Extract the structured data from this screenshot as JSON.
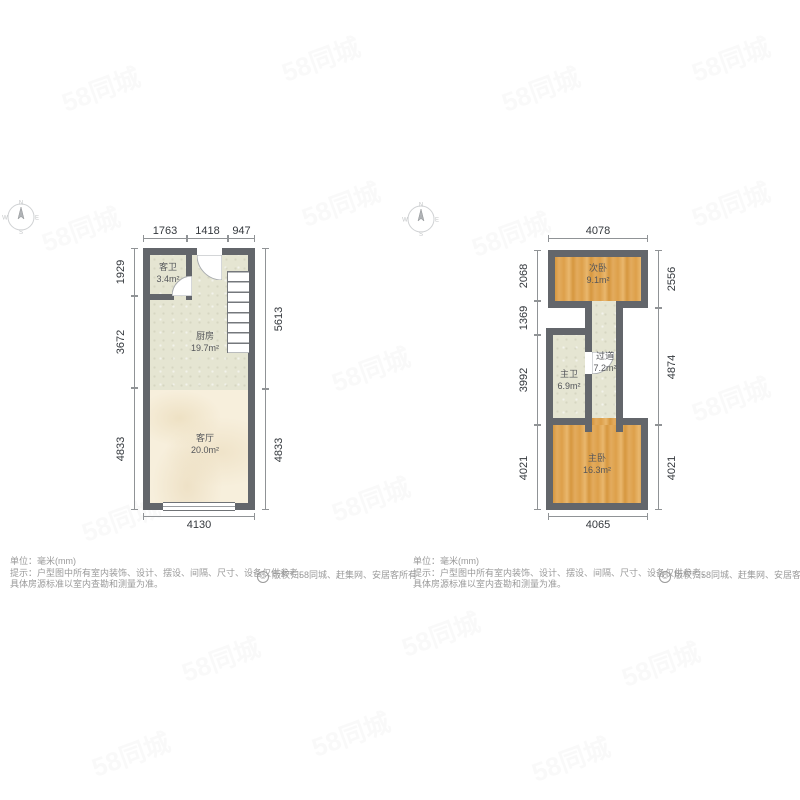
{
  "floor1": {
    "dims": {
      "top1": "1763",
      "top2": "1418",
      "top3": "947",
      "left1": "1929",
      "left2": "3672",
      "left3": "4833",
      "right1": "5613",
      "right2": "4833",
      "bottom": "4130"
    },
    "rooms": {
      "guest_bath": {
        "name": "客卫",
        "area": "3.4m²"
      },
      "kitchen": {
        "name": "厨房",
        "area": "19.7m²"
      },
      "living": {
        "name": "客厅",
        "area": "20.0m²"
      }
    }
  },
  "floor2": {
    "dims": {
      "top1": "4078",
      "left1": "2068",
      "left2": "1369",
      "left3": "3992",
      "left4": "4021",
      "right1": "2556",
      "right2": "4874",
      "right3": "4021",
      "bottom": "4065"
    },
    "rooms": {
      "second_bed": {
        "name": "次卧",
        "area": "9.1m²"
      },
      "hallway": {
        "name": "过道",
        "area": "7.2m²"
      },
      "master_bath": {
        "name": "主卫",
        "area": "6.9m²"
      },
      "master_bed": {
        "name": "主卧",
        "area": "16.3m²"
      }
    }
  },
  "footer": {
    "unit": "单位：毫米(mm)",
    "tip": "提示：户型图中所有室内装饰、设计、摆设、间隔、尺寸、设备仅供参考，",
    "tip2": "具体房源标准以室内查勘和测量为准。",
    "copyright_symbol": "©",
    "copyright": "版权归58同城、赶集网、安居客所有"
  },
  "watermark": {
    "text": "58同城"
  },
  "compass": {
    "n": "N",
    "s": "S",
    "e": "E",
    "w": "W"
  },
  "colors": {
    "wall": "#63666b",
    "wood": "#dfa755",
    "tile": "#e5e5d2",
    "marble": "#f7efdc"
  }
}
